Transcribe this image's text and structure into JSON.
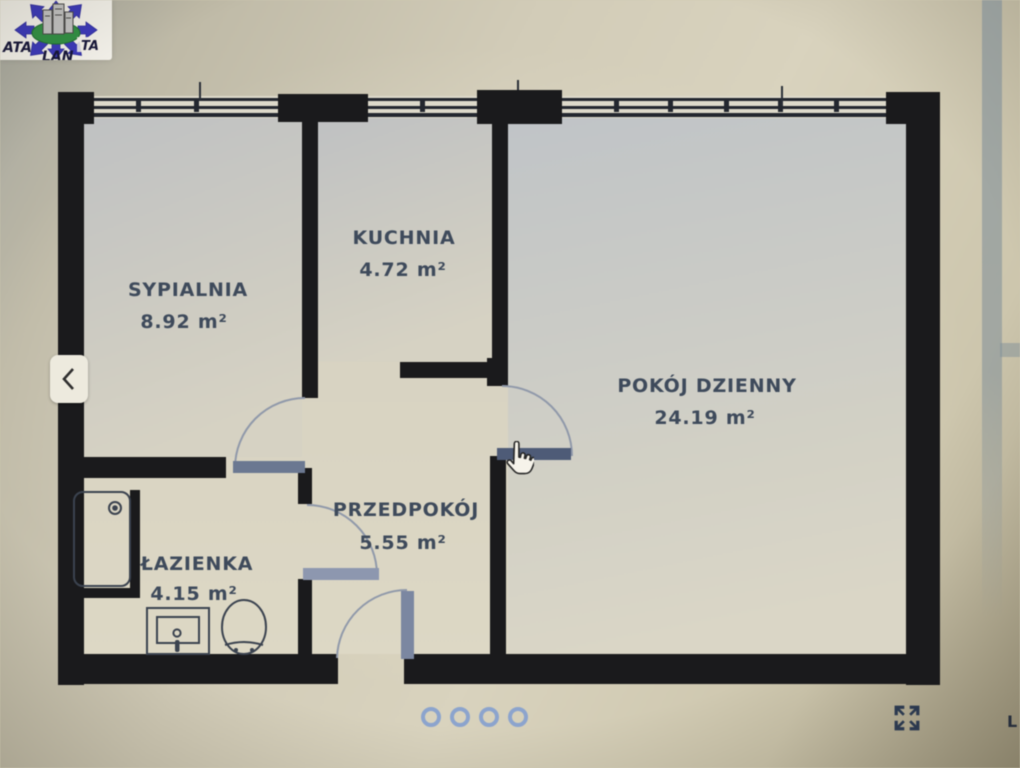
{
  "logo": {
    "text_left": "ATA",
    "text_right": "TA",
    "text_bottom": "LAN",
    "arrow_color": "#3b39bf",
    "ellipse_color": "#2e9142"
  },
  "floorplan": {
    "rooms": [
      {
        "name": "SYPIALNIA",
        "area": "8.92 m²"
      },
      {
        "name": "KUCHNIA",
        "area": "4.72 m²"
      },
      {
        "name": "POKÓJ DZIENNY",
        "area": "24.19 m²"
      },
      {
        "name": "PRZEDPOKÓJ",
        "area": "5.55 m²"
      },
      {
        "name": "ŁAZIENKA",
        "area": "4.15 m²"
      }
    ],
    "wall_color": "#1a1a1c",
    "label_color": "#3e4a5c",
    "door_leaf_color": "#5f6d89"
  },
  "carousel": {
    "dot_count": 4,
    "dot_color": "#8ba4cf"
  },
  "controls": {
    "fullscreen_icon_color": "#2b3950"
  },
  "edge_text": {
    "partial_label": "L"
  }
}
